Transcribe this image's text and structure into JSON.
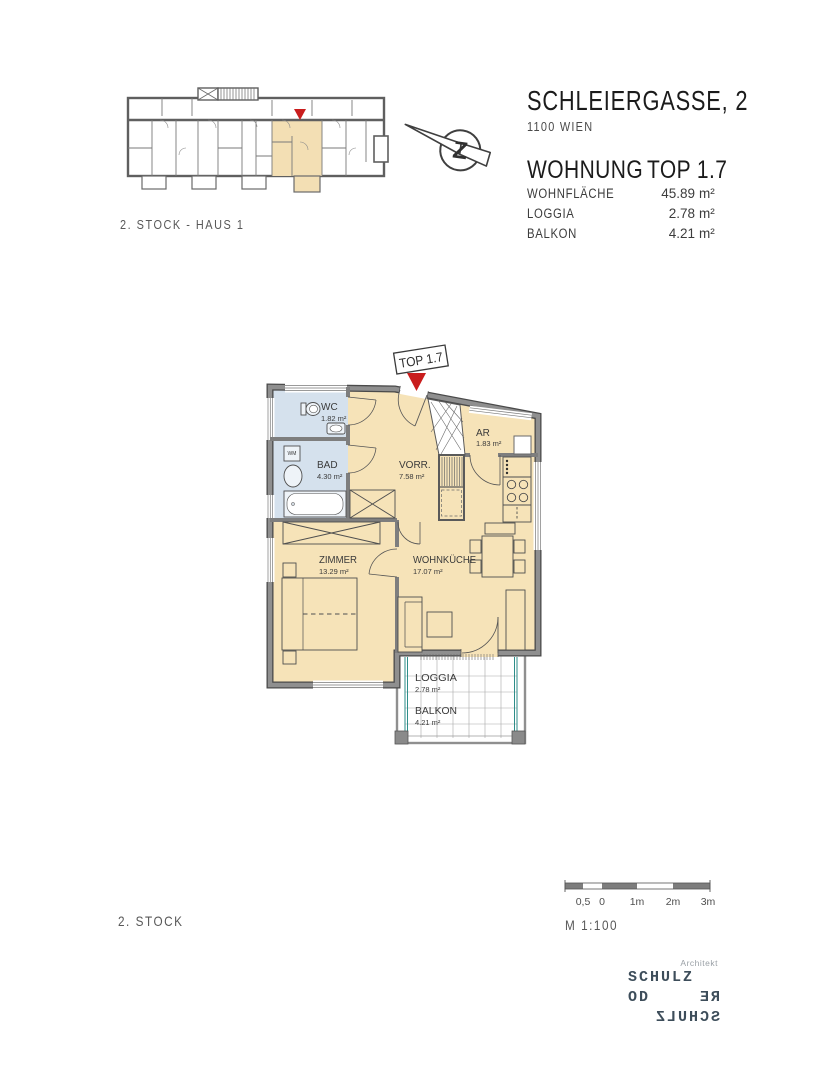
{
  "header": {
    "address": "SCHLEIERGASSE, 2",
    "city": "1100 WIEN",
    "unit_label": "WOHNUNG",
    "unit_number": "TOP 1.7",
    "area_rows": [
      {
        "label": "WOHNFLÄCHE",
        "value": "45.89",
        "unit": "m²"
      },
      {
        "label": "LOGGIA",
        "value": "2.78",
        "unit": "m²"
      },
      {
        "label": "BALKON",
        "value": "4.21",
        "unit": "m²"
      }
    ]
  },
  "overview_plan": {
    "caption": "2. STOCK - HAUS 1"
  },
  "north_arrow": {
    "letter": "Z"
  },
  "floor_plan": {
    "unit_tag": "TOP 1.7",
    "rooms": {
      "wc": {
        "name": "WC",
        "area": "1.82 m²"
      },
      "bad": {
        "name": "BAD",
        "area": "4.30 m²"
      },
      "vorraum": {
        "name": "VORR.",
        "area": "7.58 m²"
      },
      "ar": {
        "name": "AR",
        "area": "1.83 m²"
      },
      "zimmer": {
        "name": "ZIMMER",
        "area": "13.29 m²"
      },
      "wohnkueche": {
        "name": "WOHNKÜCHE",
        "area": "17.07 m²"
      },
      "loggia": {
        "name": "LOGGIA",
        "area": "2.78 m²"
      },
      "balkon": {
        "name": "BALKON",
        "area": "4.21 m²"
      }
    },
    "labels": {
      "washing_machine": "WM"
    }
  },
  "footer": {
    "floor_label": "2. STOCK",
    "scale_label": "M 1:100",
    "scale_ticks": [
      "0,5",
      "0",
      "1m",
      "2m",
      "3m"
    ]
  },
  "architect": {
    "title": "Architekt",
    "line1": "SCHULZ",
    "line2_left": "OD",
    "line2_right": "RE",
    "line3": "SCHULZ"
  },
  "colors": {
    "room_fill": "#f6e3b8",
    "wet_room_fill": "#d5e1ed",
    "wall_gray": "#8a8a8a",
    "marker_red": "#c91d1d",
    "glass_teal": "#2e8e8a",
    "logo_slate": "#3d4d5a"
  }
}
